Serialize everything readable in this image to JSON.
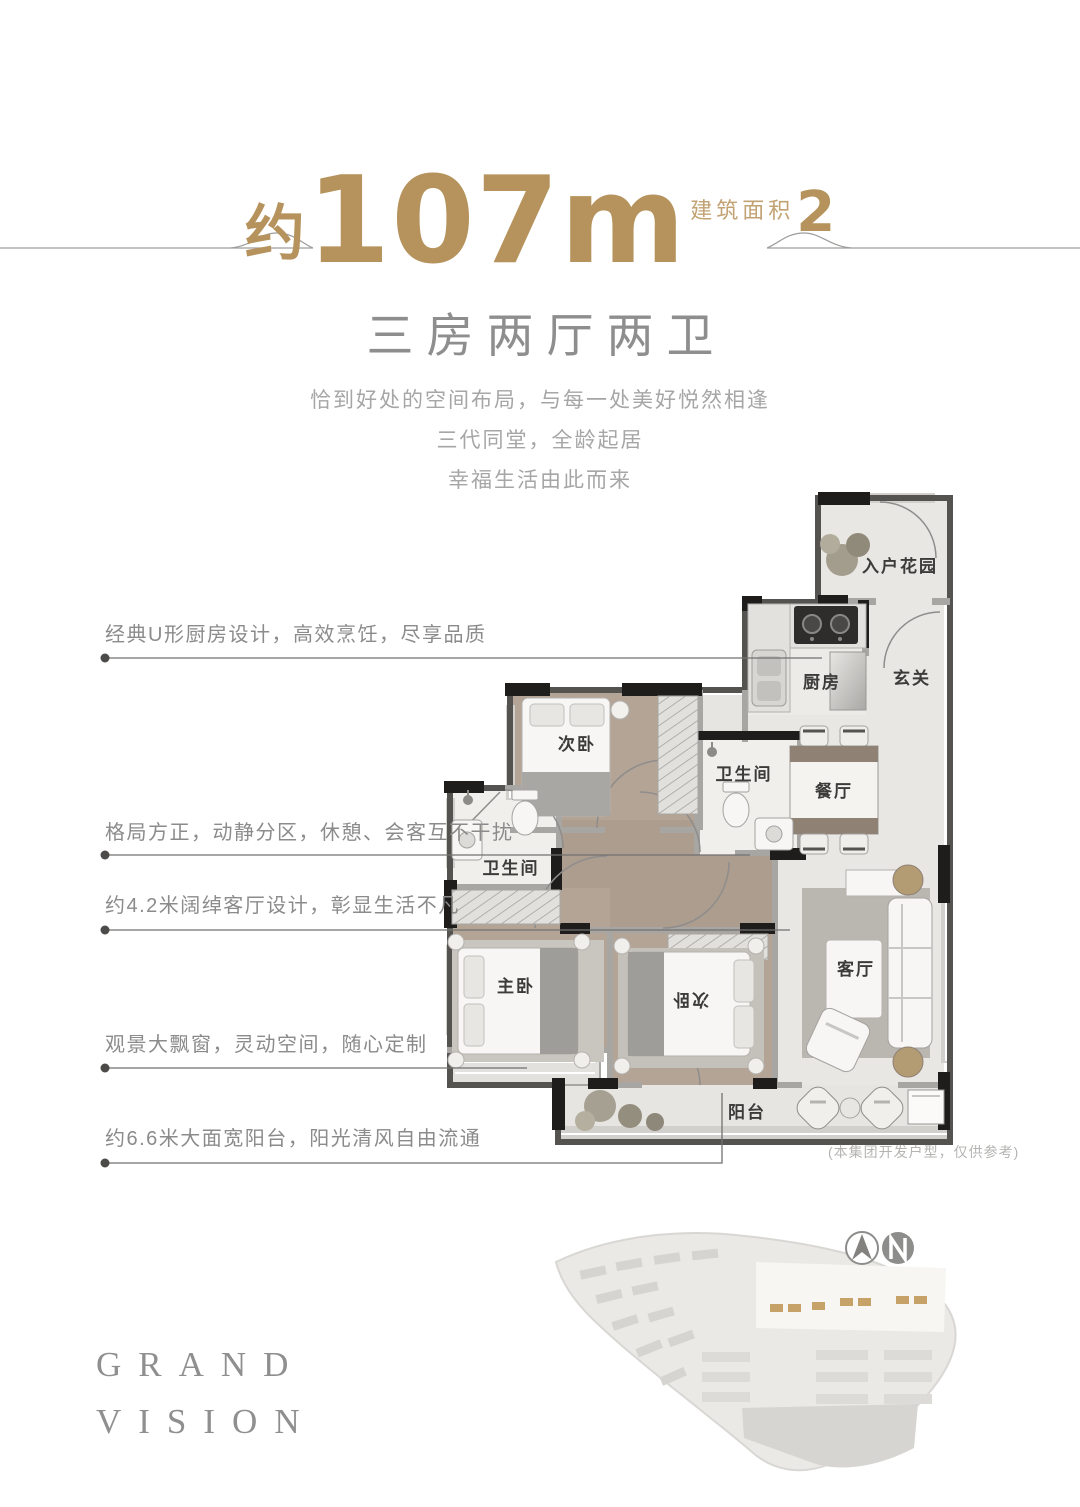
{
  "header": {
    "approx": "约",
    "area_number": "107m",
    "area_superscript": "2",
    "area_label": "建筑面积",
    "subtitle": "三房两厅两卫",
    "description_lines": [
      "恰到好处的空间布局，与每一处美好悦然相逢",
      "三代同堂，全龄起居",
      "幸福生活由此而来"
    ]
  },
  "callouts": [
    "经典U形厨房设计，高效烹饪，尽享品质",
    "格局方正，动静分区，休憩、会客互不干扰",
    "约4.2米阔绰客厅设计，彰显生活不凡",
    "观景大飘窗，灵动空间，随心定制",
    "约6.6米大面宽阳台，阳光清风自由流通"
  ],
  "floorplan": {
    "rooms": {
      "entry_garden": "入户花园",
      "foyer": "玄关",
      "kitchen": "厨房",
      "bedroom_top": "次卧",
      "bathroom_top": "卫生间",
      "dining": "餐厅",
      "bathroom_left": "卫生间",
      "master_bedroom": "主卧",
      "bedroom_bottom": "次卧",
      "living_room": "客厅",
      "balcony": "阳台"
    },
    "disclaimer": "(本集团开发户型，仅供参考)"
  },
  "footer": {
    "brand_line1": "GRAND",
    "brand_line2": "VISION"
  },
  "icons": {
    "compass": "north-arrow-compass"
  },
  "colors": {
    "accent_gold": "#b6935c",
    "area_label_gold": "#c2a273",
    "subtitle_gray": "#8e8e8e",
    "body_gray": "#a6a6a6",
    "wall_black": "#1e1d1b",
    "wall_gray": "#a8a6a3",
    "wood_floor": "#b3a496",
    "marble_floor": "#e9e7e4"
  }
}
